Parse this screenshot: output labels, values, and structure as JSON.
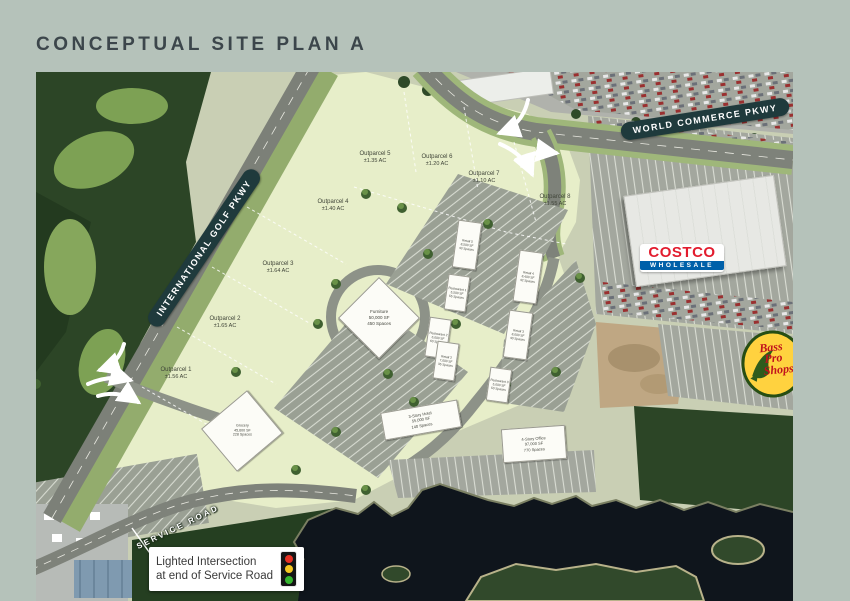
{
  "page": {
    "title": "CONCEPTUAL SITE PLAN A"
  },
  "colors": {
    "background": "#b5c2ba",
    "title": "#3c464b",
    "road_pill": "#1f3a3c",
    "parcel_green": "#e7eec9",
    "water": "#0f151c",
    "costco_red": "#e21c2e",
    "costco_blue": "#0060a9",
    "basspro_yellow": "#ffd23f",
    "basspro_red": "#c1121c"
  },
  "roads": {
    "world_commerce_pkwy": "WORLD COMMERCE PKWY",
    "international_golf_pkwy": "INTERNATIONAL GOLF PKWY",
    "service_road": "SERVICE ROAD"
  },
  "callout": {
    "line1": "Lighted Intersection",
    "line2": "at end of Service Road",
    "icon": "traffic-light-icon"
  },
  "outparcels": [
    {
      "name": "Outparcel 1",
      "area": "±1.56 AC"
    },
    {
      "name": "Outparcel 2",
      "area": "±1.65 AC"
    },
    {
      "name": "Outparcel 3",
      "area": "±1.64 AC"
    },
    {
      "name": "Outparcel 4",
      "area": "±1.40 AC"
    },
    {
      "name": "Outparcel 5",
      "area": "±1.35 AC"
    },
    {
      "name": "Outparcel 6",
      "area": "±1.20 AC"
    },
    {
      "name": "Outparcel 7",
      "area": "±1.10 AC"
    },
    {
      "name": "Outparcel 8",
      "area": "±1.55 AC"
    }
  ],
  "buildings": {
    "furniture": {
      "line1": "Furniture",
      "line2": "50,000 SF",
      "line3": "450 Spaces"
    },
    "hotel": {
      "line1": "3-Story Hotel",
      "line2": "55,000 SF",
      "line3": "140 Spaces"
    },
    "office": {
      "line1": "4-Story Office",
      "line2": "97,000 SF",
      "line3": "770 Spaces"
    },
    "anchor": {
      "line1": "Grocery",
      "line2": "45,600 SF",
      "line3": "228 Spaces"
    },
    "strip": [
      {
        "line1": "Retail 5",
        "line2": "8,500 SF",
        "line3": "43 Spaces"
      },
      {
        "line1": "Restaurant 1",
        "line2": "5,500 SF",
        "line3": "55 Spaces"
      },
      {
        "line1": "Restaurant 2",
        "line2": "6,000 SF",
        "line3": "60 Spaces"
      },
      {
        "line1": "Retail 4",
        "line2": "8,400 SF",
        "line3": "42 Spaces"
      },
      {
        "line1": "Retail 3",
        "line2": "8,000 SF",
        "line3": "40 Spaces"
      },
      {
        "line1": "Retail 2",
        "line2": "7,000 SF",
        "line3": "35 Spaces"
      },
      {
        "line1": "Restaurant 3",
        "line2": "5,000 SF",
        "line3": "50 Spaces"
      }
    ]
  },
  "logos": {
    "costco": {
      "name": "COSTCO",
      "sub": "WHOLESALE"
    },
    "bass_pro": {
      "line1": "Bass",
      "line2": "Pro",
      "line3": "Shops"
    }
  }
}
